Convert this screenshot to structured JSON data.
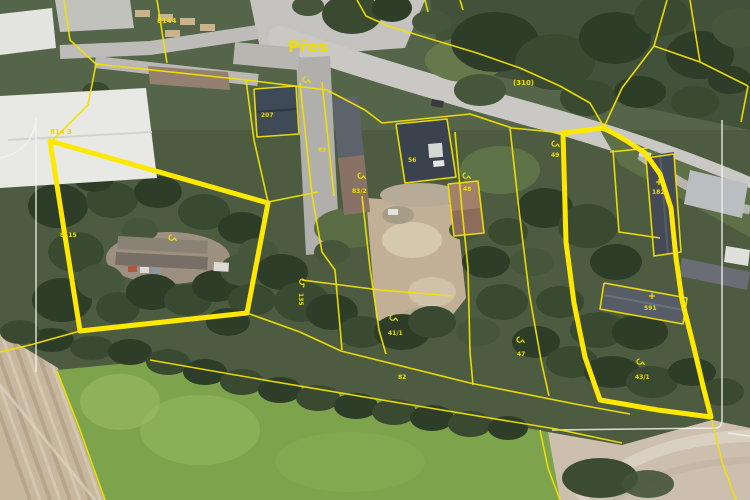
{
  "map": {
    "place_label": "Přes",
    "colors": {
      "parcel_line": "#f2e000",
      "highlight": "#ffe800",
      "frame": "#f3f3ee",
      "label": "#efdc00"
    },
    "labels": [
      {
        "text": "Přes",
        "x": 288,
        "y": 52,
        "size": 16,
        "bold": true
      },
      {
        "text": "8144",
        "x": 157,
        "y": 23,
        "size": 7
      },
      {
        "text": "814 3",
        "x": 50,
        "y": 134,
        "size": 7
      },
      {
        "text": "8115",
        "x": 60,
        "y": 237,
        "size": 6
      },
      {
        "text": "(310)",
        "x": 513,
        "y": 85,
        "size": 7
      },
      {
        "text": "207",
        "x": 261,
        "y": 117,
        "size": 6
      },
      {
        "text": "83",
        "x": 318,
        "y": 152,
        "size": 6
      },
      {
        "text": "83/2",
        "x": 352,
        "y": 193,
        "size": 6
      },
      {
        "text": "56",
        "x": 408,
        "y": 162,
        "size": 6
      },
      {
        "text": "48",
        "x": 463,
        "y": 191,
        "size": 6
      },
      {
        "text": "49",
        "x": 551,
        "y": 157,
        "size": 6
      },
      {
        "text": "182",
        "x": 652,
        "y": 194,
        "size": 6
      },
      {
        "text": "591",
        "x": 644,
        "y": 310,
        "size": 6
      },
      {
        "text": "43/1",
        "x": 635,
        "y": 379,
        "size": 6
      },
      {
        "text": "41/1",
        "x": 388,
        "y": 335,
        "size": 6
      },
      {
        "text": "82",
        "x": 398,
        "y": 379,
        "size": 6
      },
      {
        "text": "47",
        "x": 517,
        "y": 356,
        "size": 6
      },
      {
        "text": "135",
        "x": 299,
        "y": 293,
        "size": 6,
        "rotate": 90
      }
    ],
    "symbols": [
      {
        "type": "hook",
        "x": 362,
        "y": 176
      },
      {
        "type": "hook",
        "x": 467,
        "y": 176
      },
      {
        "type": "hook",
        "x": 556,
        "y": 144
      },
      {
        "type": "hook",
        "x": 641,
        "y": 362
      },
      {
        "type": "hook",
        "x": 521,
        "y": 340
      },
      {
        "type": "hook",
        "x": 394,
        "y": 318
      },
      {
        "type": "hook",
        "x": 303,
        "y": 283,
        "rotate": 45
      },
      {
        "type": "hook",
        "x": 307,
        "y": 80
      },
      {
        "type": "hook",
        "x": 173,
        "y": 238
      },
      {
        "type": "cross",
        "x": 659,
        "y": 182
      },
      {
        "type": "cross",
        "x": 652,
        "y": 296
      }
    ],
    "thin_lines": [
      "357,0 366,16 388,26 477,53 520,68 560,86 590,103 604,127",
      "604,127 622,88 654,46 667,0",
      "654,46 700,62 748,86",
      "690,0 700,62",
      "748,86 741,122",
      "64,0 70,40 96,64",
      "96,64 246,80",
      "246,80 254,140 268,202",
      "157,0 163,38 167,63",
      "96,64 88,105 52,141",
      "246,80 327,90 365,110 382,123 470,114 512,128 563,133",
      "300,83 312,195 322,252 335,270 342,350",
      "322,82 334,196",
      "268,202 318,192",
      "247,313 300,332 341,351",
      "362,196 370,268 379,330 386,354",
      "455,132 462,210 468,268 470,352 473,385",
      "302,280 380,290 452,296",
      "341,351 470,383 575,404 630,414",
      "150,360 270,381 400,403 556,429 622,443",
      "0,352 30,345 80,331",
      "57,371 80,430 105,500",
      "540,430 548,468 560,500",
      "712,420 722,462 736,500",
      "610,152 648,148",
      "613,150 619,232 660,238",
      "510,128 519,210 529,292 541,360 549,396",
      "425,0 428,12",
      "460,0 463,10",
      "254,89 296,86 299,134 257,137 254,89",
      "396,124 447,119 456,177 405,183 396,124",
      "604,283 687,298 683,324 600,309 604,283",
      "646,158 674,154 681,252 654,256 646,158",
      "448,184 478,181 484,233 454,236 448,184"
    ],
    "thick_parcels": [
      "50,141 268,203 247,313 80,331 50,141",
      "563,133 604,128 627,141 645,153 660,174 671,208 676,258 682,300 694,348 704,390 711,417 658,410 600,400 585,357 574,303 566,242 563,133"
    ],
    "frame_paths": [
      "M 0,158 Q 26,152 33,132 Q 36,124 36,118 L 36,372",
      "M 722,120 L 722,420 Q 722,427 716,428 L 552,430",
      "M 728,433 L 750,436"
    ]
  }
}
